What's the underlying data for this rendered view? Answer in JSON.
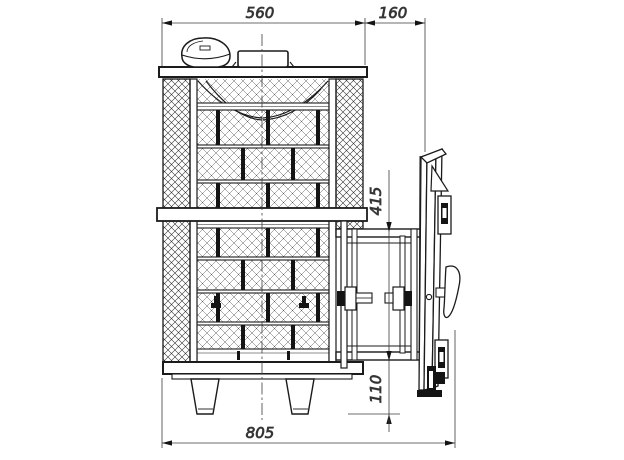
{
  "drawing": {
    "type": "technical-section-drawing",
    "subject": "stone-clad stove with open fire door",
    "colors": {
      "line": "#1b1b1b",
      "dimension_line": "#3c3c3c",
      "background": "#ffffff",
      "fill_dark": "#141414"
    },
    "dims": {
      "body_width_top": "560",
      "door_tunnel_depth": "160",
      "opening_top_height": "415",
      "opening_bottom_height": "110",
      "overall_depth": "805"
    }
  }
}
